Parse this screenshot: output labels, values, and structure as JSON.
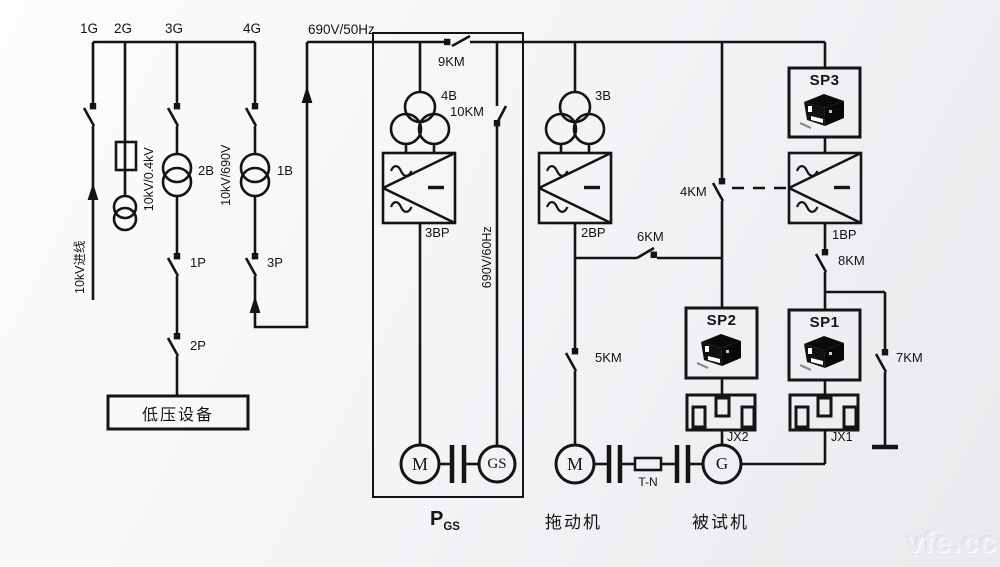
{
  "colors": {
    "line": "#141414",
    "background_top": "#fdfdfe",
    "background_bottom": "#e8eaed",
    "watermark": "#e9ebee"
  },
  "grid_section": {
    "feeder_labels": {
      "f1": "1G",
      "f2": "2G",
      "f3": "3G",
      "f4": "4G"
    },
    "incoming_label": "10kV进线",
    "transformer_2b": {
      "name": "2B",
      "ratio": "10kV/0.4kV"
    },
    "transformer_1b": {
      "name": "1B",
      "ratio": "10kV/690V"
    },
    "breaker_1p": "1P",
    "breaker_2p": "2P",
    "breaker_3p": "3P",
    "lv_equipment_label": "低压设备"
  },
  "bus_690": {
    "label": "690V/50Hz"
  },
  "pgs_section": {
    "contactor_9km": "9KM",
    "contactor_10km": "10KM",
    "transformer_4b": "4B",
    "converter_3bp": "3BP",
    "line_60hz_label": "690V/60Hz",
    "motor_label": "M",
    "generator_label": "GS",
    "caption_p": "P",
    "caption_sub": "GS"
  },
  "drive_section": {
    "transformer_3b": "3B",
    "converter_2bp": "2BP",
    "contactor_6km": "6KM",
    "contactor_5km": "5KM",
    "motor_label": "M",
    "torque_sensor_label": "T-N",
    "caption": "拖动机"
  },
  "test_section": {
    "contactor_4km": "4KM",
    "contactor_7km": "7KM",
    "contactor_8km": "8KM",
    "analyzer_sp3": "SP3",
    "analyzer_sp2": "SP2",
    "analyzer_sp1": "SP1",
    "converter_1bp": "1BP",
    "junction_jx2": "JX2",
    "junction_jx1": "JX1",
    "generator_label": "G",
    "caption": "被试机"
  },
  "watermark": "vfe.cc"
}
